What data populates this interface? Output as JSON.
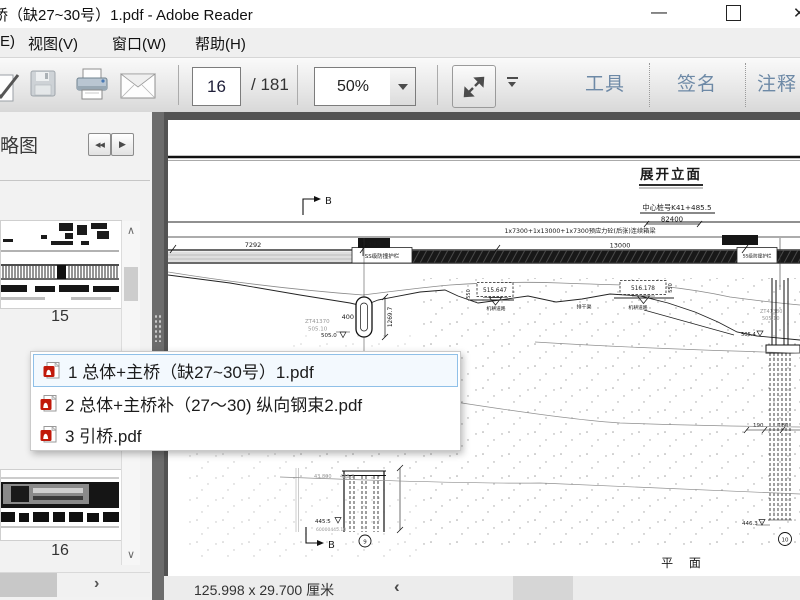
{
  "window": {
    "title": "桥（缺27~30号）1.pdf - Adobe Reader",
    "minimize_glyph": "—"
  },
  "menu": {
    "items": [
      "E)",
      "视图(V)",
      "窗口(W)",
      "帮助(H)"
    ]
  },
  "toolbar": {
    "page_current": "16",
    "page_total": "/ 181",
    "zoom_level": "50%",
    "tools_label": "工具",
    "sign_label": "签名",
    "comment_label": "注释"
  },
  "sidebar": {
    "panel_title": "略图",
    "prev_glyph": "◀◀",
    "next_glyph": "▶",
    "thumb1_label": "15",
    "thumb2_label": "16",
    "scroll_up_glyph": "∧",
    "scroll_down_glyph": "∨",
    "scroll_right_glyph": "›"
  },
  "popup": {
    "items": [
      {
        "label": "1 总体+主桥（缺27~30号）1.pdf"
      },
      {
        "label": "2 总体+主桥补（27～30) 纵向钢束2.pdf"
      },
      {
        "label": "3 引桥.pdf"
      }
    ]
  },
  "status": {
    "doc_size": "125.998 x 29.700 厘米",
    "scroll_left_glyph": "‹"
  },
  "colors": {
    "toolbar_text": "#6d89a6",
    "selection_border": "#8fc0e8",
    "pdf_icon_red": "#c1190a",
    "workspace": "#535353"
  },
  "drawing": {
    "title": "展开立面",
    "station": "中心桩号K41+485.5",
    "total_length": "82400",
    "span_text": "1x7300+1x13000+1x7300预应力砼(后张)连续箱梁",
    "dim_left": "7292",
    "dim_mid": "13000",
    "guardrail_left": "SS级防撞护栏",
    "guardrail_right": "SS级防撞护栏",
    "net_left": "防撞网",
    "net_right": "防撞网",
    "elev_box1": "515.647",
    "elev_box2": "516.178",
    "road1": "机耕道路",
    "road2": "机耕道路",
    "canal": "排干渠",
    "v550a": "550",
    "v550b": "550",
    "pier_mid_width": "400",
    "pier_mid_height": "1269.7",
    "zt_mid": "ZT41370",
    "zt_mid_elev": "505.10",
    "elev_mid": "505.0",
    "zt_right": "ZT41380",
    "zt_right_elev": "505.10",
    "elev_right": "505.4",
    "dim_190": "190",
    "dim_180": "180",
    "elev_right_base": "446.3",
    "pier_no_right": "10",
    "geo_left1": "43.800",
    "geo_left2": "488.3",
    "elev_left_base": "445.5",
    "geo_left3": "60000445.10",
    "pier_no_left": "9",
    "section_b_top": "B",
    "section_b_bottom": "B",
    "plan_title": "平 面"
  }
}
